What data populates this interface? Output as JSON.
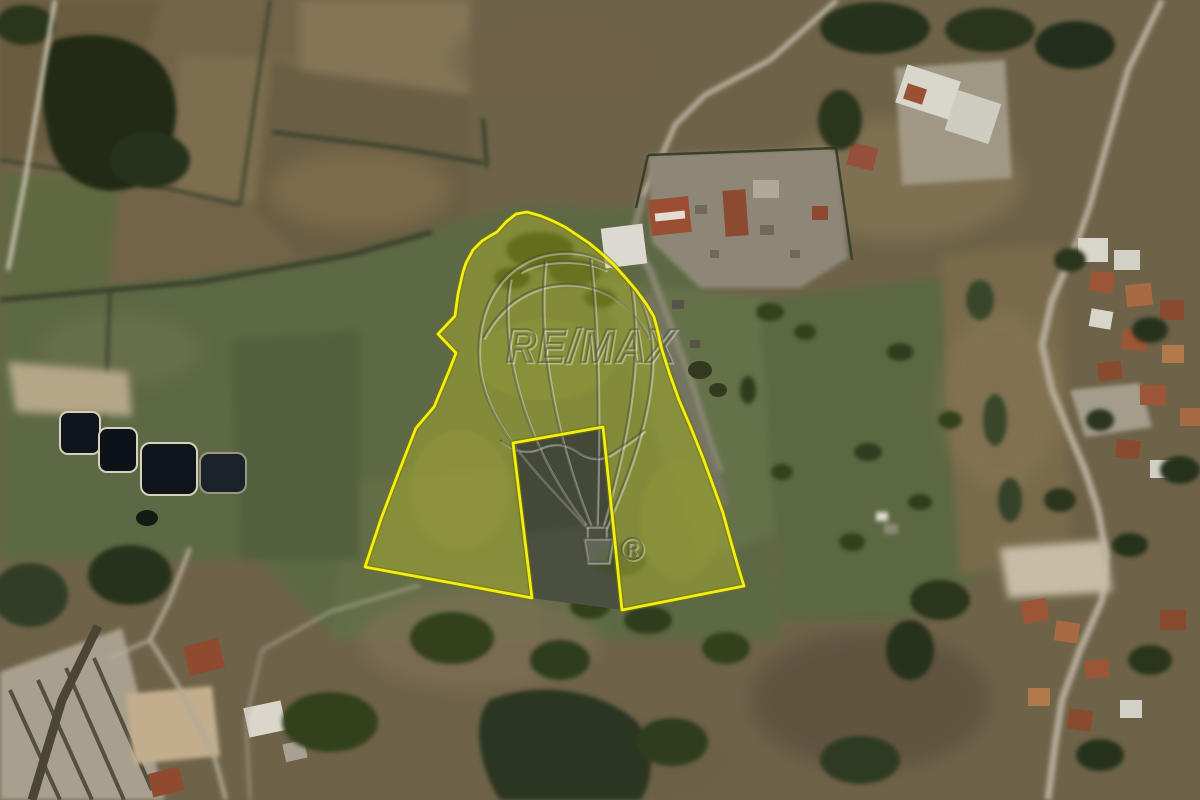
{
  "scene": {
    "description": "Aerial satellite view of rural farmland with a highlighted land parcel",
    "parcel": {
      "outline_points": "497,232 506,222 516,214 527,212 541,216 553,221 565,227 577,235 589,243 601,253 613,264 624,276 636,290 647,305 654,317 657,328 662,350 670,375 679,400 691,428 703,458 714,488 723,513 731,542 739,570 744,586 622,610 603,427 513,443 532,598 463,585 365,567 381,519 398,474 416,428 434,407 449,371 456,353 438,334 455,316 458,294 463,272 466,263 473,250 482,241 490,236",
      "cutout_points": "513,443 603,427 622,610 532,598",
      "boundary_color": "#f2ef15",
      "boundary_halo_color": "#787200",
      "fill_color": "rgba(240,235,25,0.26)"
    },
    "watermark": {
      "brand": "RE/MAX",
      "registered_mark": "®",
      "icon": "remax-balloon-icon"
    }
  }
}
